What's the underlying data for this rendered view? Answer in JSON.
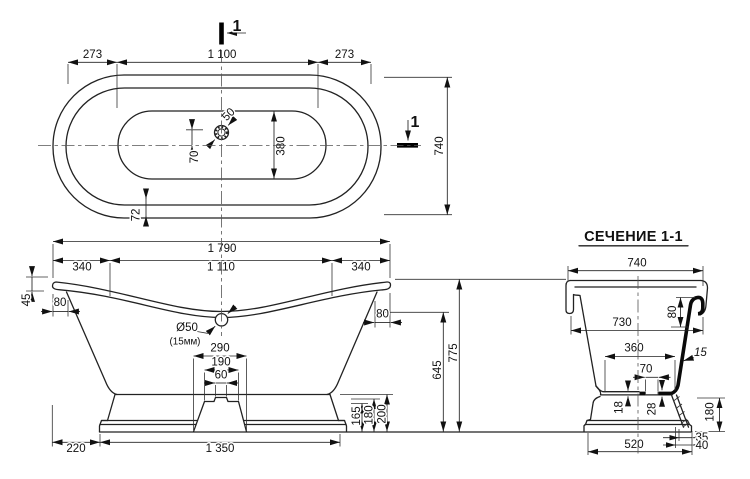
{
  "top_view": {
    "dim_left_end": "273",
    "dim_inner_length": "1 100",
    "dim_right_end": "273",
    "dim_width": "740",
    "dim_basin_width": "380",
    "dim_drain_offset": "70",
    "dim_drain_hole": "50",
    "dim_rim": "72",
    "cut_label_top": "1",
    "cut_label_right": "1"
  },
  "side_view": {
    "dim_total_length": "1 790",
    "dim_end_left": "340",
    "dim_rim_length": "1 110",
    "dim_end_right": "340",
    "dim_rim_rise": "45",
    "dim_overhang_left": "80",
    "dim_overhang_right": "80",
    "drain_diameter": "Ø50",
    "drain_note": "(15мм)",
    "dim_cutout_bottom": "290",
    "dim_cutout_top": "190",
    "dim_notch": "60",
    "dim_height_rim_low": "645",
    "dim_height_total": "775",
    "dim_base_step1": "165",
    "dim_base_step2": "180",
    "dim_base_step3": "200",
    "dim_base_offset": "220",
    "dim_base_length": "1 350"
  },
  "section_view": {
    "title": "СЕЧЕНИЕ 1-1",
    "dim_width_total": "740",
    "dim_rim_drop": "80",
    "dim_width_rim": "730",
    "dim_width_bottom": "360",
    "dim_wall_thickness": "15",
    "dim_drain_offset": "70",
    "dim_bottom_thin": "18",
    "dim_bottom_thick": "28",
    "dim_base_height": "180",
    "dim_edge_35": "35",
    "dim_edge_40": "40",
    "dim_base_width": "520"
  }
}
